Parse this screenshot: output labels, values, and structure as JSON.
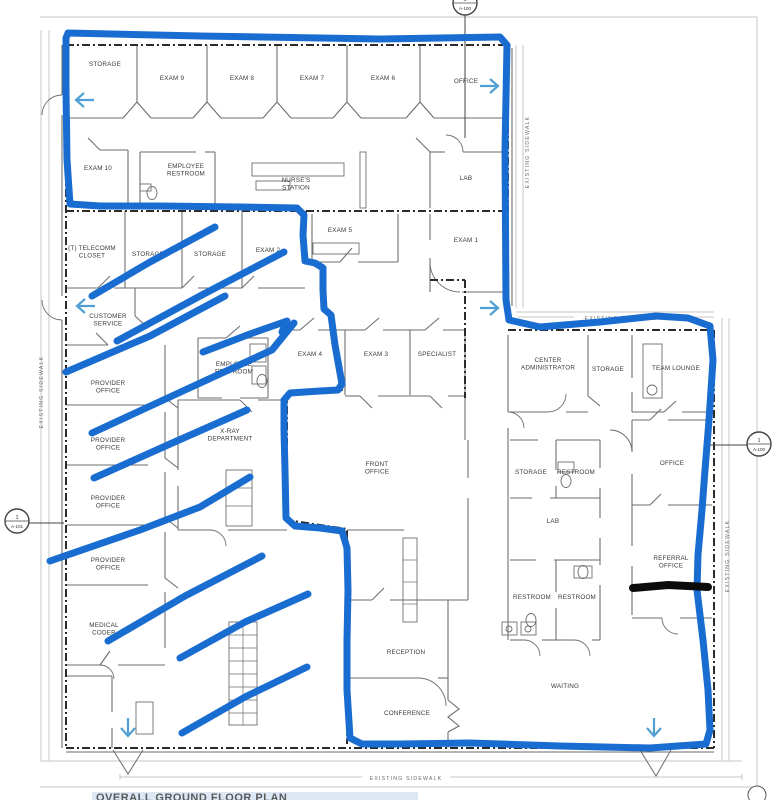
{
  "sheet": {
    "title": "OVERALL GROUND FLOOR PLAN"
  },
  "colors": {
    "marker_blue": "#1a6dd0",
    "marker_black": "#0b0b0b",
    "plan_arrow_blue": "#4f9fd4",
    "wall_gray": "#6e6e6e",
    "dark_line": "#2b2b2b",
    "frame_gray": "#c6c6c6",
    "label_gray": "#3a3a3a",
    "sidewalk_gray": "#6a6a6a",
    "title_highlight": "#dde7f4"
  },
  "rooms": [
    {
      "lines": [
        "STORAGE"
      ],
      "x": 105,
      "y": 66
    },
    {
      "lines": [
        "EXAM 9"
      ],
      "x": 172,
      "y": 80
    },
    {
      "lines": [
        "EXAM 8"
      ],
      "x": 242,
      "y": 80
    },
    {
      "lines": [
        "EXAM 7"
      ],
      "x": 312,
      "y": 80
    },
    {
      "lines": [
        "EXAM 6"
      ],
      "x": 383,
      "y": 80
    },
    {
      "lines": [
        "OFFICE"
      ],
      "x": 466,
      "y": 83
    },
    {
      "lines": [
        "EXAM 10"
      ],
      "x": 98,
      "y": 170
    },
    {
      "lines": [
        "EMPLOYEE",
        "RESTROOM"
      ],
      "x": 186,
      "y": 168
    },
    {
      "lines": [
        "NURSE'S",
        "STATION"
      ],
      "x": 296,
      "y": 182
    },
    {
      "lines": [
        "LAB"
      ],
      "x": 466,
      "y": 180
    },
    {
      "lines": [
        "(T) TELECOMM",
        "CLOSET"
      ],
      "x": 92,
      "y": 250
    },
    {
      "lines": [
        "STORAGE"
      ],
      "x": 148,
      "y": 256
    },
    {
      "lines": [
        "STORAGE"
      ],
      "x": 210,
      "y": 256
    },
    {
      "lines": [
        "EXAM 2"
      ],
      "x": 268,
      "y": 252
    },
    {
      "lines": [
        "EXAM 5"
      ],
      "x": 340,
      "y": 232
    },
    {
      "lines": [
        "EXAM 1"
      ],
      "x": 466,
      "y": 242
    },
    {
      "lines": [
        "CUSTOMER",
        "SERVICE"
      ],
      "x": 108,
      "y": 318
    },
    {
      "lines": [
        "PROVIDER",
        "OFFICE"
      ],
      "x": 108,
      "y": 385
    },
    {
      "lines": [
        "PROVIDER",
        "OFFICE"
      ],
      "x": 108,
      "y": 442
    },
    {
      "lines": [
        "PROVIDER",
        "OFFICE"
      ],
      "x": 108,
      "y": 500
    },
    {
      "lines": [
        "PROVIDER",
        "OFFICE"
      ],
      "x": 108,
      "y": 562
    },
    {
      "lines": [
        "MEDICAL",
        "CODER"
      ],
      "x": 104,
      "y": 627
    },
    {
      "lines": [
        "EMPLOYEE",
        "RESTROOM"
      ],
      "x": 234,
      "y": 366
    },
    {
      "lines": [
        "EXAM 4"
      ],
      "x": 310,
      "y": 356
    },
    {
      "lines": [
        "EXAM 3"
      ],
      "x": 376,
      "y": 356
    },
    {
      "lines": [
        "SPECIALIST"
      ],
      "x": 437,
      "y": 356
    },
    {
      "lines": [
        "X-RAY",
        "DEPARTMENT"
      ],
      "x": 230,
      "y": 433
    },
    {
      "lines": [
        "FRONT",
        "OFFICE"
      ],
      "x": 377,
      "y": 466
    },
    {
      "lines": [
        "CENTER",
        "ADMINISTRATOR"
      ],
      "x": 548,
      "y": 362
    },
    {
      "lines": [
        "STORAGE"
      ],
      "x": 608,
      "y": 371
    },
    {
      "lines": [
        "TEAM LOUNGE"
      ],
      "x": 676,
      "y": 370
    },
    {
      "lines": [
        "OFFICE"
      ],
      "x": 672,
      "y": 465
    },
    {
      "lines": [
        "STORAGE"
      ],
      "x": 531,
      "y": 474
    },
    {
      "lines": [
        "RESTROOM"
      ],
      "x": 576,
      "y": 474
    },
    {
      "lines": [
        "LAB"
      ],
      "x": 553,
      "y": 523
    },
    {
      "lines": [
        "RESTROOM"
      ],
      "x": 532,
      "y": 599
    },
    {
      "lines": [
        "RESTROOM"
      ],
      "x": 577,
      "y": 599
    },
    {
      "lines": [
        "REFERRAL",
        "OFFICE"
      ],
      "x": 671,
      "y": 560
    },
    {
      "lines": [
        "WAITING"
      ],
      "x": 565,
      "y": 688
    },
    {
      "lines": [
        "RECEPTION"
      ],
      "x": 406,
      "y": 654
    },
    {
      "lines": [
        "CONFERENCE"
      ],
      "x": 407,
      "y": 715
    }
  ],
  "sidewalk_labels": [
    {
      "text": "EXISTING SIDEWALK",
      "x": 529,
      "y": 152,
      "rot": -90
    },
    {
      "text": "EXISTING SIDEWALK",
      "x": 621,
      "y": 320,
      "rot": 0
    },
    {
      "text": "EXISTING SIDEWALK",
      "x": 729,
      "y": 556,
      "rot": -90
    },
    {
      "text": "EXISTING SIDEWALK",
      "x": 43,
      "y": 392,
      "rot": -90
    },
    {
      "text": "EXISTING SIDEWALK",
      "x": 406,
      "y": 780,
      "rot": 0
    }
  ],
  "callouts": [
    {
      "x": 465,
      "y": 3,
      "r": 12,
      "top": "1",
      "bottom": "A-100",
      "leader": [
        465,
        15,
        465,
        138
      ]
    },
    {
      "x": 17,
      "y": 521,
      "r": 12,
      "top": "1",
      "bottom": "A-101",
      "leader": [
        29,
        523,
        64,
        523
      ]
    },
    {
      "x": 759,
      "y": 444,
      "r": 12,
      "top": "1",
      "bottom": "A-100",
      "leader": [
        704,
        445,
        747,
        445
      ]
    }
  ],
  "annotations": {
    "perimeter": [
      [
        68,
        33
      ],
      [
        200,
        36
      ],
      [
        380,
        39
      ],
      [
        500,
        37
      ],
      [
        507,
        45
      ],
      [
        505,
        150
      ],
      [
        506,
        300
      ],
      [
        509,
        320
      ],
      [
        540,
        327
      ],
      [
        600,
        322
      ],
      [
        656,
        316
      ],
      [
        688,
        318
      ],
      [
        710,
        326
      ],
      [
        713,
        360
      ],
      [
        709,
        420
      ],
      [
        705,
        470
      ],
      [
        702,
        510
      ],
      [
        698,
        555
      ],
      [
        697,
        590
      ],
      [
        703,
        640
      ],
      [
        708,
        690
      ],
      [
        710,
        730
      ],
      [
        706,
        744
      ],
      [
        650,
        748
      ],
      [
        560,
        746
      ],
      [
        470,
        743
      ],
      [
        400,
        744
      ],
      [
        362,
        744
      ],
      [
        350,
        738
      ],
      [
        347,
        690
      ],
      [
        347,
        640
      ],
      [
        348,
        590
      ],
      [
        347,
        548
      ],
      [
        342,
        531
      ],
      [
        320,
        528
      ],
      [
        295,
        526
      ],
      [
        286,
        518
      ],
      [
        285,
        470
      ],
      [
        284,
        430
      ],
      [
        284,
        400
      ],
      [
        290,
        393
      ],
      [
        320,
        391
      ],
      [
        338,
        390
      ],
      [
        342,
        384
      ],
      [
        335,
        345
      ],
      [
        331,
        315
      ],
      [
        324,
        309
      ],
      [
        323,
        290
      ],
      [
        323,
        268
      ],
      [
        315,
        263
      ],
      [
        305,
        261
      ],
      [
        303,
        235
      ],
      [
        304,
        215
      ],
      [
        297,
        208
      ],
      [
        240,
        207
      ],
      [
        160,
        206
      ],
      [
        100,
        206
      ],
      [
        70,
        204
      ],
      [
        67,
        160
      ],
      [
        66,
        90
      ],
      [
        66,
        38
      ]
    ],
    "hatch_strokes": [
      [
        [
          92,
          296
        ],
        [
          150,
          262
        ],
        [
          215,
          227
        ]
      ],
      [
        [
          117,
          341
        ],
        [
          200,
          296
        ],
        [
          284,
          252
        ]
      ],
      [
        [
          66,
          372
        ],
        [
          150,
          336
        ],
        [
          225,
          296
        ]
      ],
      [
        [
          203,
          352
        ],
        [
          250,
          334
        ],
        [
          287,
          321
        ],
        [
          282,
          332
        ]
      ],
      [
        [
          92,
          433
        ],
        [
          185,
          390
        ],
        [
          272,
          350
        ],
        [
          294,
          323
        ]
      ],
      [
        [
          94,
          478
        ],
        [
          170,
          444
        ],
        [
          247,
          410
        ]
      ],
      [
        [
          50,
          561
        ],
        [
          140,
          530
        ],
        [
          200,
          507
        ],
        [
          250,
          477
        ]
      ],
      [
        [
          108,
          641
        ],
        [
          185,
          596
        ],
        [
          262,
          556
        ]
      ],
      [
        [
          180,
          658
        ],
        [
          245,
          622
        ],
        [
          308,
          594
        ]
      ],
      [
        [
          182,
          733
        ],
        [
          245,
          697
        ],
        [
          307,
          667
        ]
      ]
    ],
    "black_line": [
      [
        633,
        588
      ],
      [
        668,
        585
      ],
      [
        708,
        587
      ]
    ],
    "arrows": [
      {
        "x": 74,
        "y": 100,
        "dir": "left"
      },
      {
        "x": 500,
        "y": 86,
        "dir": "right"
      },
      {
        "x": 75,
        "y": 306,
        "dir": "left"
      },
      {
        "x": 500,
        "y": 308,
        "dir": "right"
      },
      {
        "x": 128,
        "y": 738,
        "dir": "down"
      },
      {
        "x": 654,
        "y": 738,
        "dir": "down"
      }
    ]
  }
}
